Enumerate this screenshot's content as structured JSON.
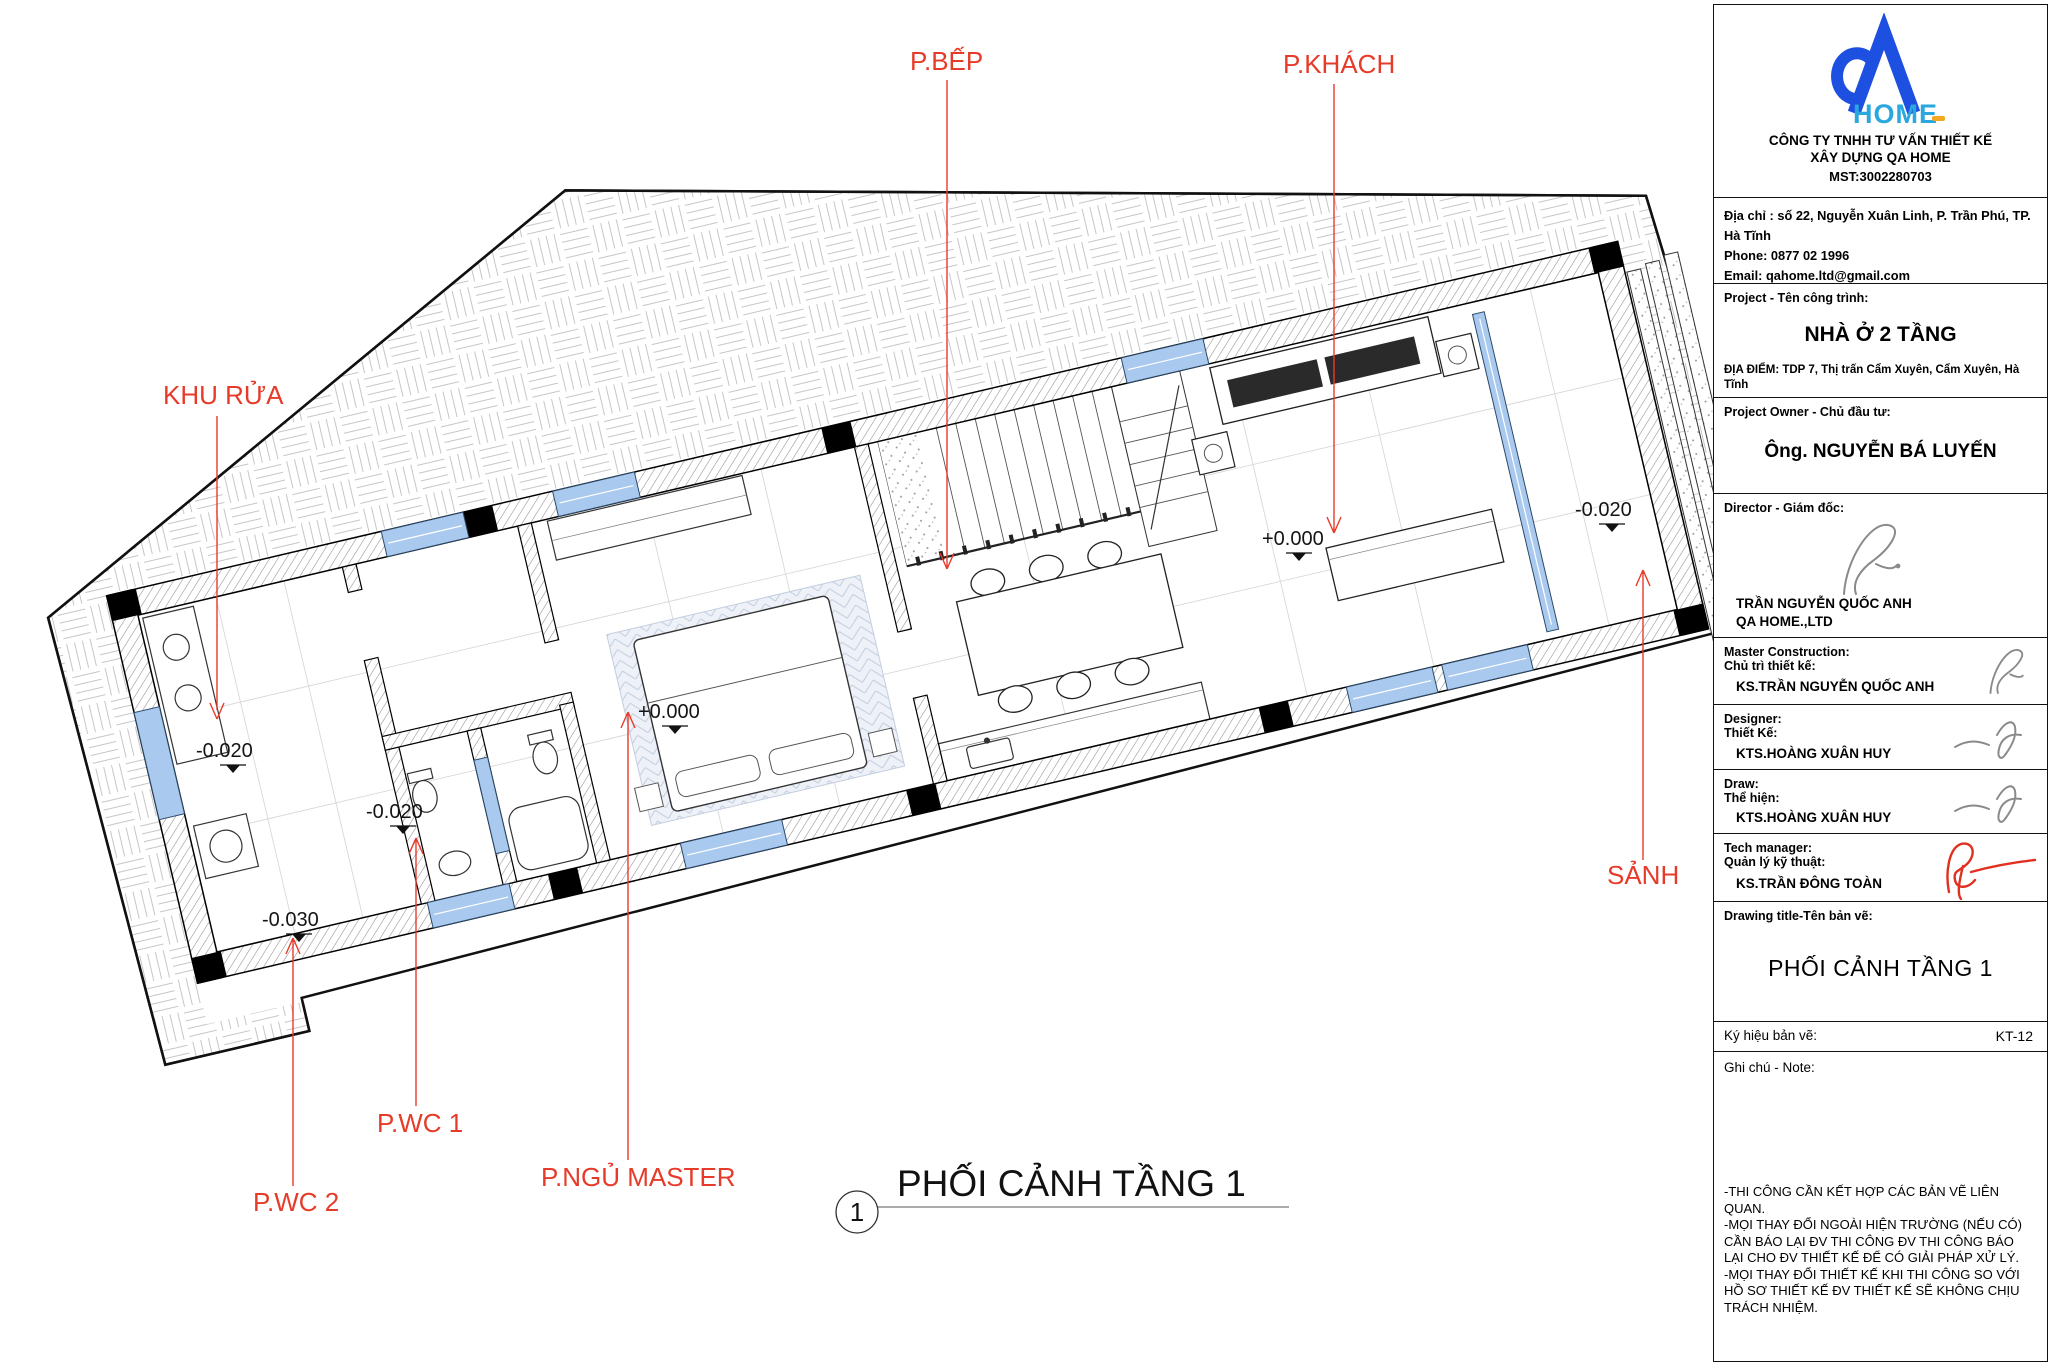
{
  "plan": {
    "room_labels": {
      "khu_rua": "KHU RỬA",
      "p_bep": "P.BẾP",
      "p_khach": "P.KHÁCH",
      "sanh": "SẢNH",
      "p_wc_1": "P.WC 1",
      "p_wc_2": "P.WC 2",
      "p_ngu_master": "P.NGỦ MASTER"
    },
    "levels": {
      "khu_rua": "-0.020",
      "wc1": "-0.020",
      "wc2": "-0.030",
      "master": "+0.000",
      "living": "+0.000",
      "porch": "-0.020"
    },
    "caption": {
      "number": "1",
      "title": "PHỐI CẢNH TẦNG 1"
    }
  },
  "title_block": {
    "logo": {
      "brand": "QA",
      "wordmark": "HOME"
    },
    "company_line1": "CÔNG TY TNHH TƯ VẤN THIẾT KẾ",
    "company_line2": "XÂY DỰNG QA HOME",
    "tax_id": "MST:3002280703",
    "address": "Địa chỉ : số 22, Nguyễn Xuân Linh, P. Trần Phú, TP. Hà Tĩnh",
    "phone": "Phone: 0877 02 1996",
    "email": "Email: qahome.ltd@gmail.com",
    "website": "Website: qahome.net",
    "project_label": "Project - Tên công trình:",
    "project_name": "NHÀ Ở 2 TẦNG",
    "location": "ĐỊA ĐIỂM: TDP 7, Thị trấn Cẩm Xuyên, Cẩm Xuyên, Hà Tĩnh",
    "owner_label": "Project Owner - Chủ đầu tư:",
    "owner_name": "Ông. NGUYỄN BÁ LUYẾN",
    "director_label": "Director - Giám đốc:",
    "director_name": "TRẦN NGUYỄN QUỐC ANH",
    "director_company": "QA HOME.,LTD",
    "master_label_en": "Master Construction:",
    "master_label_vi": "Chủ trì thiết kế:",
    "master_name": "KS.TRẦN NGUYỄN QUỐC ANH",
    "designer_label_en": "Designer:",
    "designer_label_vi": "Thiết Kế:",
    "designer_name": "KTS.HOÀNG XUÂN HUY",
    "draw_label_en": "Draw:",
    "draw_label_vi": "Thể hiện:",
    "draw_name": "KTS.HOÀNG XUÂN HUY",
    "tech_label_en": "Tech manager:",
    "tech_label_vi": "Quản lý kỹ thuật:",
    "tech_name": "KS.TRẦN ĐÔNG TOÀN",
    "drawing_title_label": "Drawing title-Tên bản vẽ:",
    "drawing_title": "PHỐI CẢNH TẦNG 1",
    "code_label": "Ký hiệu bản vẽ:",
    "code": "KT-12",
    "note_label": "Ghi chú - Note:",
    "notes": [
      "-THI CÔNG CẦN KẾT HỢP CÁC BẢN VẼ LIÊN QUAN.",
      "-MỌI THAY ĐỔI NGOÀI HIỆN TRƯỜNG (NẾU CÓ) CẦN BÁO LẠI ĐV THI CÔNG ĐV THI CÔNG BÁO LẠI CHO ĐV THIẾT KẾ ĐỂ CÓ GIẢI PHÁP XỬ LÝ.",
      "-MỌI THAY ĐỔI THIẾT KẾ KHI THI CÔNG SO VỚI HỒ SƠ THIẾT KẾ ĐV THIẾT KẾ SẼ KHÔNG CHỊU TRÁCH NHIỆM."
    ]
  },
  "colors": {
    "label_red": "#e73b2a",
    "logo_blue": "#1d4fe0",
    "logo_teal": "#2aa7dd",
    "logo_orange": "#f5a623",
    "window_blue": "#aac9ee"
  }
}
